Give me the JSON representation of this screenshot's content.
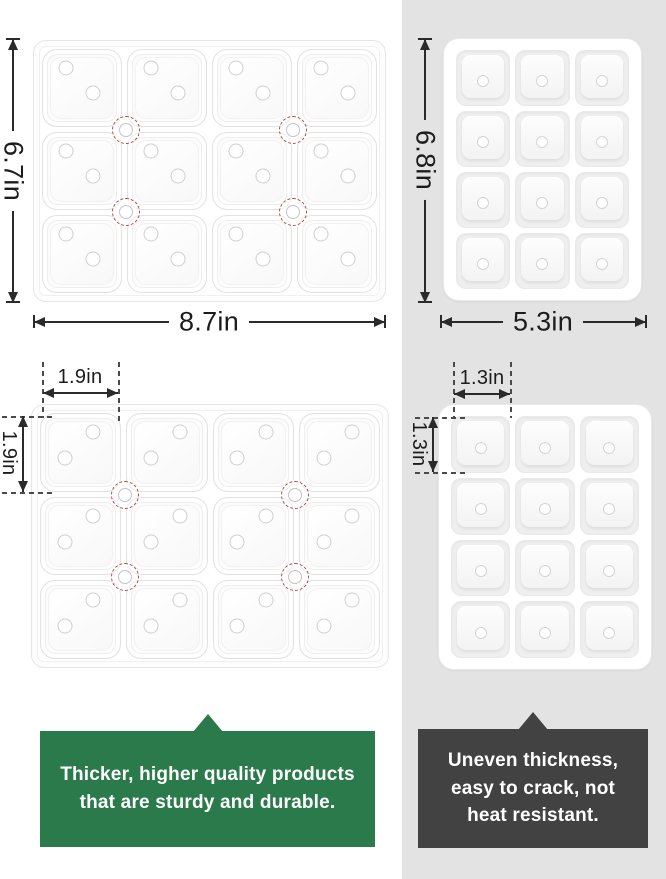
{
  "colors": {
    "panel_gray": "#e3e3e3",
    "good_callout_green": "#2b7a4c",
    "bad_callout_gray": "#424242",
    "marker_red": "#b04a44",
    "dimension_ink": "#2a2a2a"
  },
  "dims": {
    "good_tray": {
      "height": "6.7in",
      "width": "8.7in"
    },
    "bad_tray": {
      "height": "6.8in",
      "width": "5.3in"
    },
    "good_cell": {
      "width": "1.9in",
      "height": "1.9in"
    },
    "bad_cell": {
      "width": "1.3in",
      "height": "1.3in"
    }
  },
  "trays": {
    "good_top": {
      "rows": 3,
      "cols": 4,
      "style": "a",
      "markers": true,
      "pips": [
        {
          "x": 30,
          "y": 24
        },
        {
          "x": 64,
          "y": 56
        }
      ]
    },
    "good_bottom": {
      "rows": 3,
      "cols": 4,
      "style": "a",
      "markers": true,
      "pips": [
        {
          "x": 66,
          "y": 24
        },
        {
          "x": 30,
          "y": 58
        }
      ]
    },
    "bad_top": {
      "rows": 4,
      "cols": 3,
      "style": "b",
      "markers": false,
      "pips": [
        {
          "x": 50,
          "y": 55
        }
      ]
    },
    "bad_bottom": {
      "rows": 4,
      "cols": 3,
      "style": "b",
      "markers": false,
      "pips": [
        {
          "x": 50,
          "y": 56
        }
      ]
    }
  },
  "callouts": {
    "good": {
      "lines": [
        "Thicker, higher quality products",
        "that are sturdy and durable."
      ]
    },
    "bad": {
      "lines": [
        "Uneven thickness,",
        "easy to crack, not",
        "heat resistant."
      ]
    }
  }
}
